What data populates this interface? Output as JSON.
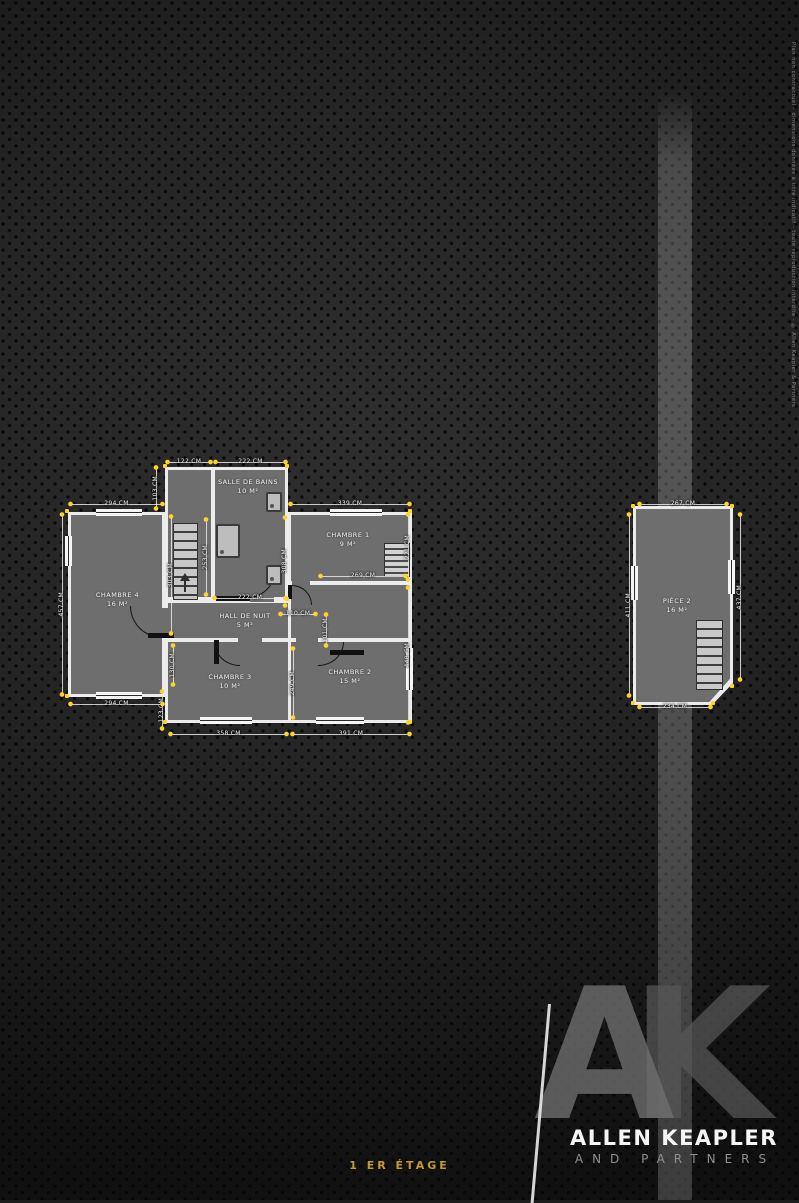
{
  "page": {
    "caption": "1 ER ÉTAGE"
  },
  "branding": {
    "monogram_a": "A",
    "monogram_k": "K",
    "name": "ALLEN KEAPLER",
    "subtitle": "AND PARTNERS"
  },
  "fineprint": "Plan non contractuel - dimensions données à titre indicatif - toute reproduction interdite - © Allen Keapler & Partners",
  "colors": {
    "background": "#1c1c1c",
    "floor": "#6e6e6e",
    "wall": "#ececec",
    "dimension_dot": "#ffd42a",
    "caption_gold": "#c49a33"
  },
  "main_plan": {
    "rooms": {
      "chambre4": {
        "name": "CHAMBRE 4",
        "area": "16 M²"
      },
      "salle_de_bains": {
        "name": "SALLE DE BAINS",
        "area": "10 M²"
      },
      "chambre1": {
        "name": "CHAMBRE 1",
        "area": "9 M²"
      },
      "hall": {
        "name": "HALL DE NUIT",
        "area": "5 M²"
      },
      "chambre3": {
        "name": "CHAMBRE 3",
        "area": "10 M²"
      },
      "chambre2": {
        "name": "CHAMBRE 2",
        "area": "15 M²"
      }
    },
    "dims": {
      "d294t": "294 CM",
      "d122": "122 CM",
      "d222t": "222 CM",
      "d339": "339 CM",
      "d457": "457 CM",
      "d103": "103 CM",
      "d303": "303 CM",
      "d253": "253 CM",
      "d308": "308 CM",
      "d221": "221 CM",
      "d448": "448 CM",
      "d269": "269 CM",
      "d222h": "222 CM",
      "d110": "110 CM",
      "d101": "101 CM",
      "d130": "130 CM",
      "d123": "123 CM",
      "d249": "249 CM",
      "d294b": "294 CM",
      "d358": "358 CM",
      "d391": "391 CM"
    }
  },
  "annex_plan": {
    "room": {
      "name": "PIÈCE 2",
      "area": "16 M²"
    },
    "dims": {
      "d267": "267 CM",
      "d234": "234 CM",
      "d411": "411 CM",
      "d437": "437 CM"
    }
  }
}
